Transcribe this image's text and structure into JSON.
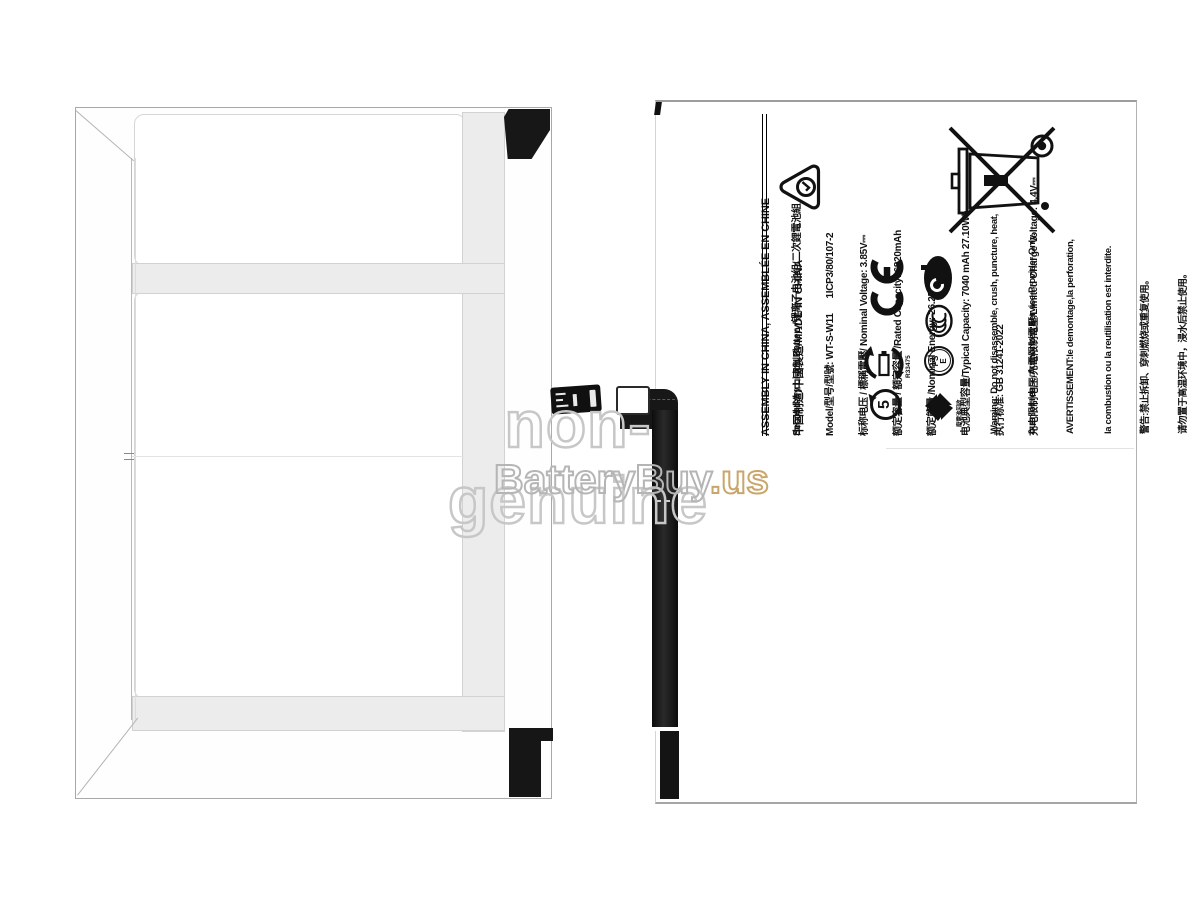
{
  "watermark": {
    "line1": "non-genuine",
    "brand": "BatteryBuy",
    "suffix": ".us",
    "line1_color": "#c7c7c7",
    "brand_color": "#b5b5b5",
    "suffix_color": "#c9a66b"
  },
  "label": {
    "header_line1": "ASSEMBLY IN CHINA, ASSEMBLÉE EN CHINE",
    "header_line2": "中国制造/中國製造/MADE IN CHINA",
    "specs": [
      "Secondary Li-ion Battery/锂离子电池组/二次鋰電池組",
      "Model/型号/型號: WT-S-W11      1ICP3/80/107-2",
      "标称电压 / 標稱電壓/ Nominal Voltage: 3.85V⎓",
      "额定容量 / 額定容量 /Rated Capacity: 6820mAh",
      "额定能量 /Nominal Energy: 26.25Wh",
      "电池典型容量/Typical Capacity: 7040 mAh 27.10Wh",
      "执行标准: GB 31241-2022",
      "充电限制电压/充電限制電壓/Limited Charge Voltage: 4.4V⎓"
    ],
    "warnings": [
      "Warning: Do not disassemble, crush, puncture, heat,",
      "burn or reuse.Authorized Service Provider Only.",
      "AVERTISSEMENT:le demontage,la perforation,",
      "la combustion ou la reutilisation est interdite.",
      "警告:禁止拆卸、穿刺燃烧或重复使用。",
      "请勿置于高温环境中，浸水后禁止使用。",
      "警告:禁止拆卸、穿刺燃燒或重複使用。",
      "請勿置於高溫環境中，浸水後禁止使用。"
    ],
    "marks": {
      "battery_recycle_code": "R33475",
      "pse_top": "PS",
      "pse_bottom": "E",
      "recycle_number": "5",
      "taiwan_recycle_text": "廢電池回收"
    }
  }
}
